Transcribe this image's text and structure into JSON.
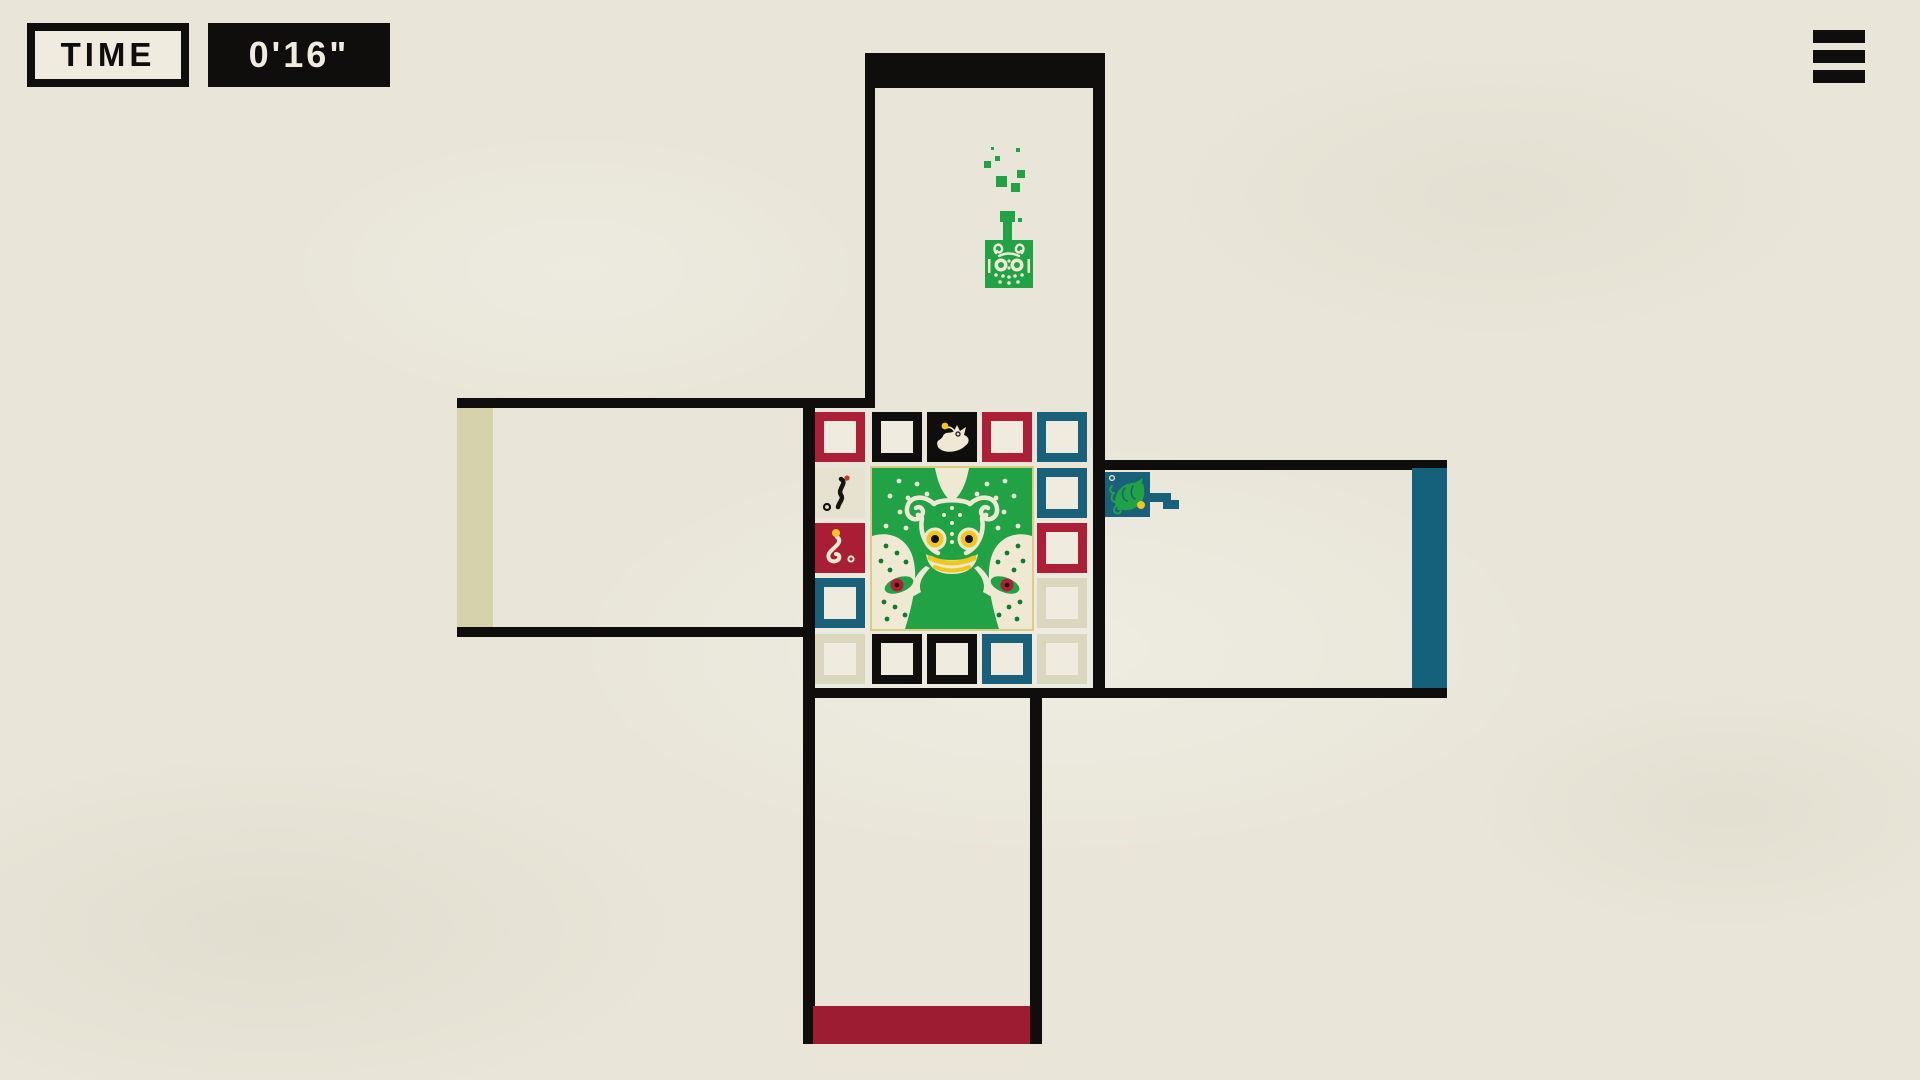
{
  "hud": {
    "time_label": "TIME",
    "time_value": "0'16\""
  },
  "icons": {
    "menu": "hamburger-icon"
  },
  "palette": {
    "paper": "#e9e6d9",
    "paperLight": "#efecdf",
    "ink": "#0f0e0c",
    "red": "#ad1f36",
    "redDeep": "#9e1c31",
    "teal": "#19617b",
    "tealDeep": "#15607b",
    "green": "#21a345",
    "greenDark": "#0e7a33",
    "beige": "#d6d2ac",
    "pale": "#dbd7bf",
    "cream": "#efe9d3",
    "cream2": "#e6e2d0",
    "yellow": "#f2c71c"
  },
  "level": {
    "walls": [
      [
        865,
        53,
        10,
        355
      ],
      [
        1093,
        53,
        12,
        645
      ],
      [
        457,
        398,
        418,
        10
      ],
      [
        457,
        627,
        356,
        10
      ],
      [
        803,
        398,
        12,
        646
      ],
      [
        803,
        688,
        644,
        10
      ],
      [
        1093,
        460,
        354,
        10
      ],
      [
        1030,
        698,
        12,
        346
      ]
    ],
    "exits": [
      {
        "side": "top",
        "color": "#0f0e0c",
        "rect": [
          865,
          53,
          238,
          35
        ]
      },
      {
        "side": "left",
        "color": "#d6d2ac",
        "rect": [
          457,
          408,
          36,
          219
        ]
      },
      {
        "side": "right",
        "color": "#15607b",
        "rect": [
          1412,
          468,
          35,
          220
        ]
      },
      {
        "side": "bottom",
        "color": "#9e1c31",
        "rect": [
          813,
          1006,
          217,
          38
        ]
      }
    ],
    "grid": {
      "cols": [
        815,
        872,
        927,
        982,
        1037
      ],
      "rows": [
        412,
        468,
        523,
        578,
        634
      ],
      "cell": 50,
      "cells": [
        {
          "r": 0,
          "c": 0,
          "type": "outline",
          "color": "#ad1f36"
        },
        {
          "r": 0,
          "c": 1,
          "type": "outline",
          "color": "#0f0e0c"
        },
        {
          "r": 0,
          "c": 2,
          "type": "tile",
          "color": "#0f0e0c",
          "glyph": "bird"
        },
        {
          "r": 0,
          "c": 3,
          "type": "outline",
          "color": "#ad1f36"
        },
        {
          "r": 0,
          "c": 4,
          "type": "outline",
          "color": "#19617b"
        },
        {
          "r": 1,
          "c": 0,
          "type": "tile",
          "color": "#e6e2d0",
          "glyph": "worm"
        },
        {
          "r": 1,
          "c": 4,
          "type": "outline",
          "color": "#19617b"
        },
        {
          "r": 2,
          "c": 0,
          "type": "tile",
          "color": "#a91e35",
          "glyph": "snake"
        },
        {
          "r": 2,
          "c": 4,
          "type": "outline",
          "color": "#ad1f36"
        },
        {
          "r": 3,
          "c": 0,
          "type": "outline",
          "color": "#19617b"
        },
        {
          "r": 3,
          "c": 4,
          "type": "outline",
          "color": "#dbd7bf"
        },
        {
          "r": 4,
          "c": 0,
          "type": "outline",
          "color": "#dbd7bf"
        },
        {
          "r": 4,
          "c": 1,
          "type": "outline",
          "color": "#0f0e0c"
        },
        {
          "r": 4,
          "c": 2,
          "type": "outline",
          "color": "#0f0e0c"
        },
        {
          "r": 4,
          "c": 3,
          "type": "outline",
          "color": "#19617b"
        },
        {
          "r": 4,
          "c": 4,
          "type": "outline",
          "color": "#dbd7bf"
        }
      ],
      "art": {
        "name": "frog-totem",
        "rect": [
          872,
          468,
          160,
          161
        ]
      }
    }
  },
  "pieces": {
    "green_frog": {
      "tile": [
        985,
        240,
        48,
        48
      ],
      "stem": [
        1003,
        221,
        9,
        20
      ],
      "stem_tip": [
        1000,
        211,
        15,
        11
      ],
      "particles": [
        [
          995,
          156,
          5
        ],
        [
          984,
          161,
          7
        ],
        [
          1016,
          148,
          4
        ],
        [
          1017,
          170,
          8
        ],
        [
          996,
          176,
          11
        ],
        [
          1011,
          183,
          9
        ],
        [
          1018,
          218,
          4
        ],
        [
          991,
          147,
          3
        ]
      ]
    },
    "chameleon": {
      "tile": [
        1105,
        472,
        45,
        45
      ],
      "tongue": [
        [
          1150,
          493,
          21,
          9
        ],
        [
          1163,
          500,
          16,
          9
        ]
      ]
    }
  }
}
